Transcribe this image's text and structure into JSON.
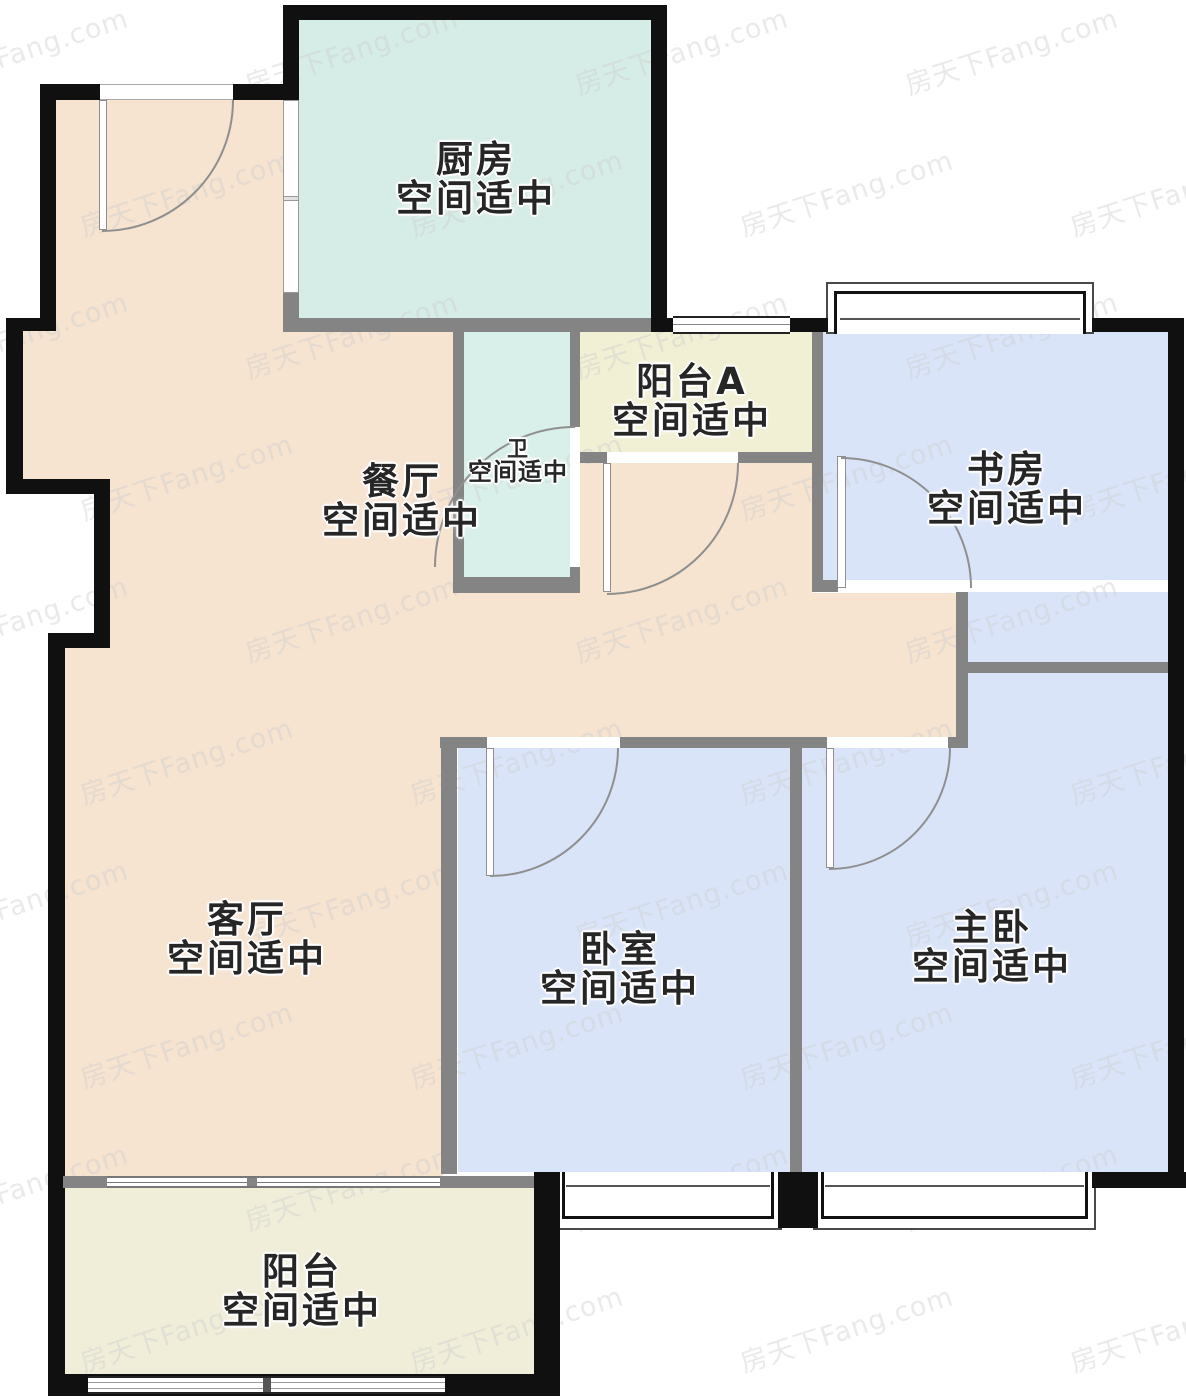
{
  "floorplan": {
    "watermark_text": "房天下Fang.com",
    "rooms": [
      {
        "id": "kitchen",
        "name": "厨房",
        "status": "空间适中"
      },
      {
        "id": "balcony-a",
        "name": "阳台A",
        "status": "空间适中"
      },
      {
        "id": "study",
        "name": "书房",
        "status": "空间适中"
      },
      {
        "id": "dining",
        "name": "餐厅",
        "status": "空间适中"
      },
      {
        "id": "bathroom",
        "name": "卫",
        "status": "空间适中"
      },
      {
        "id": "living",
        "name": "客厅",
        "status": "空间适中"
      },
      {
        "id": "bedroom",
        "name": "卧室",
        "status": "空间适中"
      },
      {
        "id": "master-bedroom",
        "name": "主卧",
        "status": "空间适中"
      },
      {
        "id": "balcony",
        "name": "阳台",
        "status": "空间适中"
      }
    ],
    "colors": {
      "exterior_wall": "#101010",
      "partition_wall": "#848484",
      "kitchen": "#d6ece6",
      "bathroom": "#d9efe9",
      "living_dining": "#f6e3d0",
      "balcony_a": "#f1f0d4",
      "balcony": "#f0eed9",
      "bedroom": "#d9e4f8",
      "door_arc": "#8f8f8f",
      "label_text": "#262626"
    }
  }
}
